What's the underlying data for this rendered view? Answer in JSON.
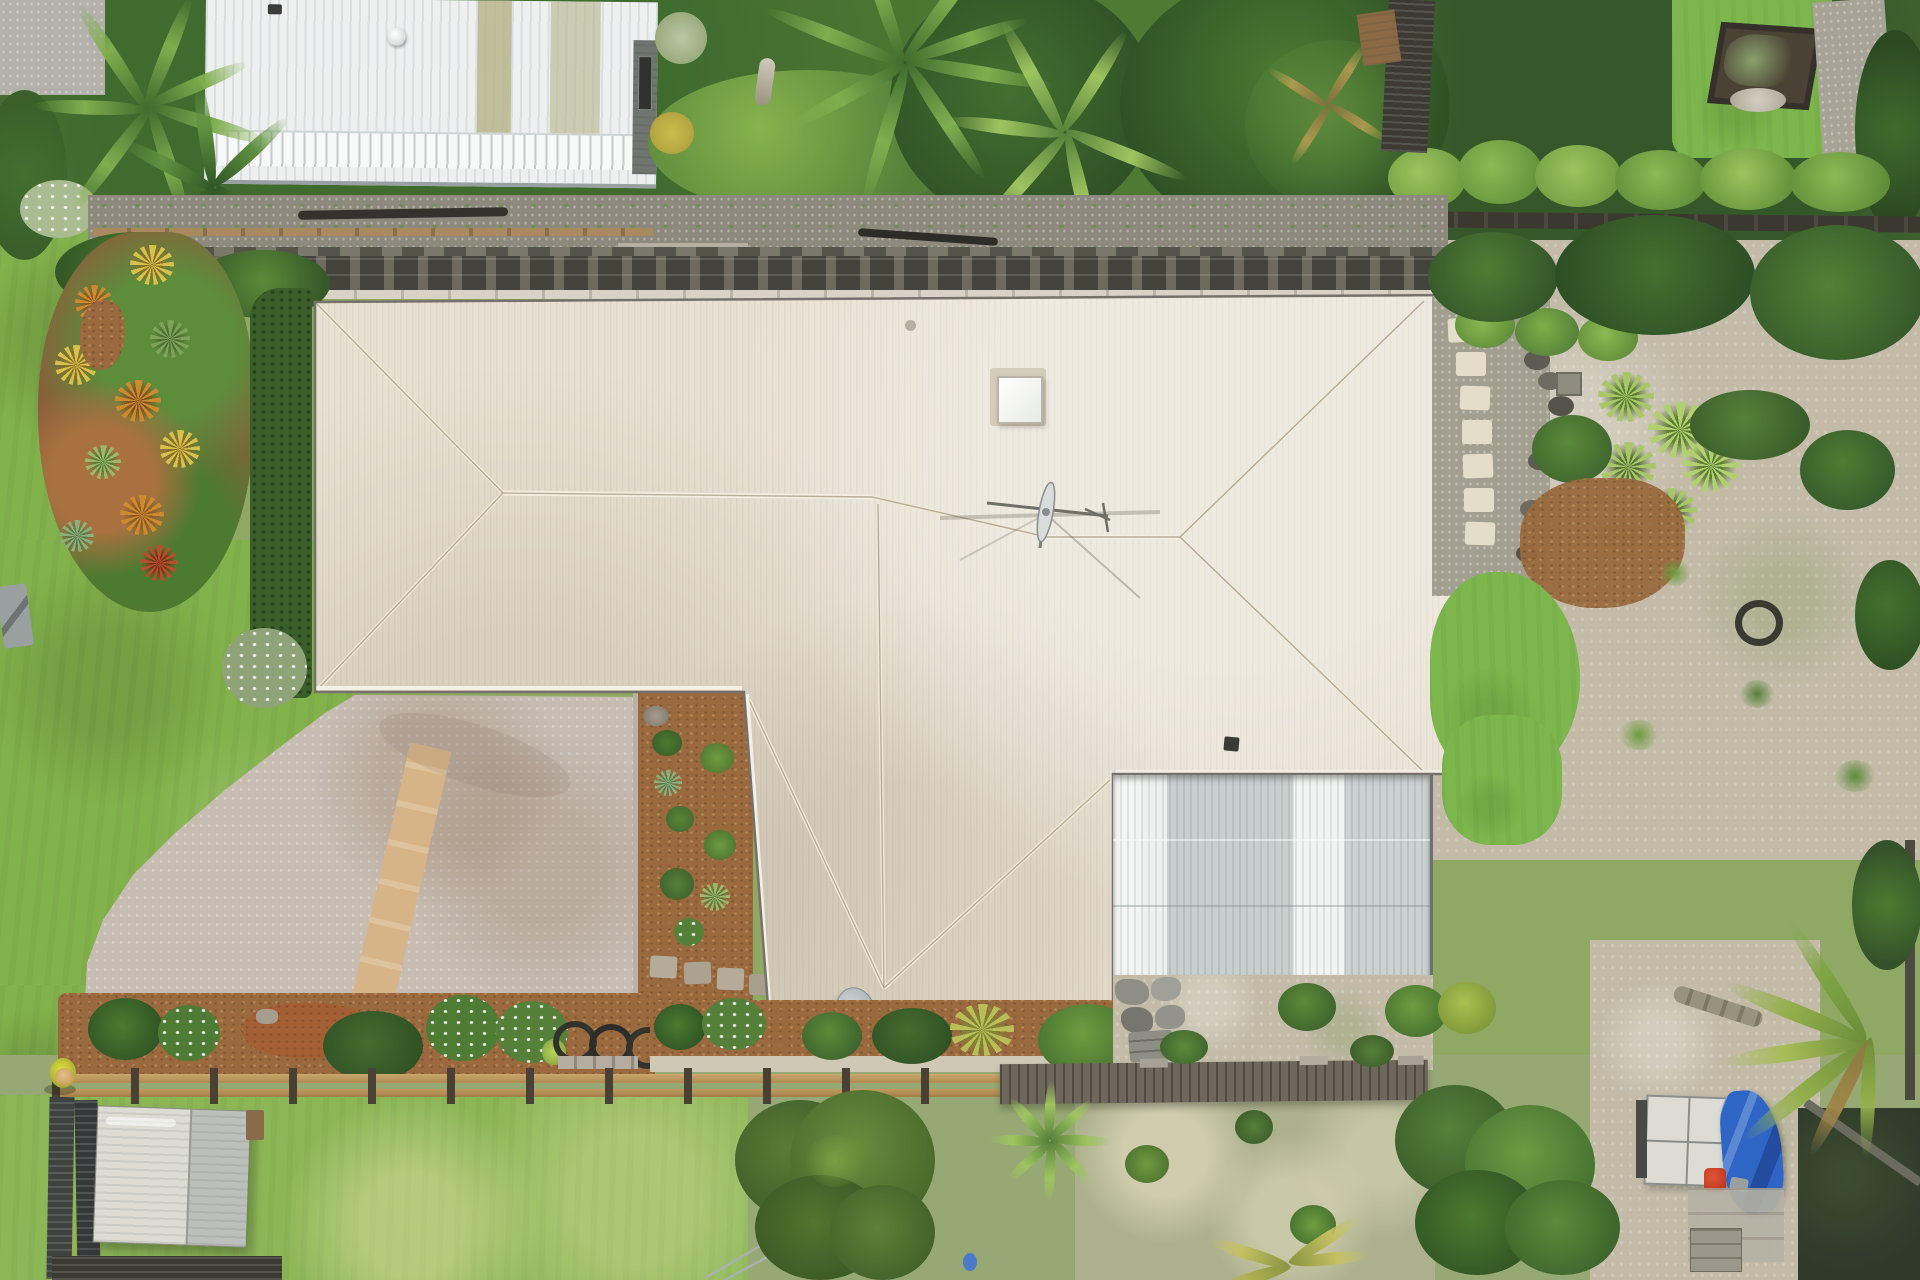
{
  "meta": {
    "image_type": "aerial-drone-photograph",
    "subject": "single-storey house with cream hip roof, tropical landscaped yard, driveway, retaining wall and neighbouring shed roof",
    "view": "top-down (nadir)",
    "width_px": 1920,
    "height_px": 1280
  },
  "colors": {
    "roof_cream": "#e8e1d3",
    "roof_shade": "#dcd3c2",
    "roof_ridge": "#f3eee2",
    "gutter": "#76716a",
    "garage_white": "#f2f4f3",
    "garage_gray": "#c7cdcc",
    "neighbor_white": "#eef0f0",
    "neighbor_stripe": "#b6b48b",
    "wall_dark": "#45443c",
    "wall_light": "#6d6a5d",
    "gravel": "#8d897c",
    "concrete": "#b2b0a9",
    "lawn": "#82b24c",
    "lawn_bright": "#7cb64c",
    "lawn_pale": "#aab87e",
    "hedge": "#3a5f2a",
    "shrub_dark": "#3f652e",
    "shrub_mid": "#55803a",
    "shrub_light": "#6f9c40",
    "foliage_bright": "#86b34d",
    "yucca": "#a8c868",
    "mulch": "#9a6a3e",
    "scoria": "#a55f35",
    "bed_mulch": "#8a5f3b",
    "driveway": "#c6bcb2",
    "tan_path": "#d7b488",
    "sand": "#c3bba8",
    "sand_pale": "#cfc8b5",
    "fence_new": "#c9a66c",
    "fence_post": "#4a4136",
    "fence_old": "#6e675b",
    "shed_light": "#dcdcd5",
    "shed_gray": "#bcc0bd",
    "gate_dark": "#3e4340",
    "tarp_blue": "#2f66c6",
    "red_item": "#c03a22",
    "bromeliad_orange": "#cf8a2e",
    "bromeliad_yellow": "#d8c14a",
    "bromeliad_red": "#b4512c",
    "hivis_vest": "#dde23e",
    "hat_tan": "#c9a05c",
    "dish_gray": "#aeb6ba",
    "skylight_white": "#fcfcfa",
    "stone_gray": "#8e8e85",
    "paver_cream": "#e3ddc9",
    "tree_dark": "#2f5126",
    "tree_mid": "#4b7a33",
    "tree_light": "#5d8a3c"
  },
  "scene": {
    "main_roof": {
      "bbox": [
        310,
        294,
        1145,
        714
      ],
      "note": "cream corrugated hip roof with skylight, TV antenna, two vents"
    },
    "garage_roof": {
      "bbox": [
        1113,
        775,
        317,
        200
      ],
      "note": "white/gray corrugated attached garage roof"
    },
    "neighbor_roof": {
      "bbox": [
        205,
        0,
        452,
        182
      ],
      "note": "white ribbed shed roof with olive stripes and round vent"
    },
    "retaining_wall": {
      "bbox": [
        90,
        247,
        1367,
        45
      ],
      "note": "dark crib-block retaining wall along rear of house"
    },
    "driveway": {
      "bbox": [
        85,
        695,
        570,
        312
      ],
      "note": "exposed-aggregate driveway with tan sandstone path"
    },
    "courtyard_bed": {
      "bbox": [
        633,
        688,
        115,
        312
      ],
      "note": "mulched entry garden with stepping pavers"
    },
    "front_bed": {
      "bbox": [
        60,
        993,
        1053,
        82
      ],
      "note": "agapanthus / shrub bed with three tires"
    },
    "new_fence": {
      "bbox": [
        52,
        1068,
        950,
        35
      ],
      "note": "new timber rail fence under construction"
    },
    "old_fence": {
      "bbox": [
        1000,
        1062,
        425,
        42
      ],
      "note": "old dark timber fence/boardwalk"
    },
    "worker": {
      "bbox": [
        46,
        1048,
        36,
        46
      ],
      "note": "person in hi-vis vest and hat at fence"
    },
    "shed": {
      "bbox": [
        95,
        1108,
        168,
        135
      ],
      "note": "weathered timber shed below fence"
    },
    "small_shed_br": {
      "bbox": [
        1638,
        1096,
        90,
        86
      ],
      "note": "small panel-roof structure, bottom right"
    },
    "blue_tarp": {
      "bbox": [
        1722,
        1090,
        58,
        122
      ],
      "note": "blue tarpaulin"
    },
    "satellite_dish": {
      "bbox": [
        832,
        988,
        46,
        52
      ],
      "note": "gray satellite dish at front eave"
    },
    "skylight": {
      "bbox": [
        995,
        373,
        46,
        48
      ],
      "note": "white roof skylight"
    },
    "antenna": {
      "bbox": [
        985,
        468,
        155,
        90
      ],
      "note": "TV antenna at ridge junction"
    }
  }
}
